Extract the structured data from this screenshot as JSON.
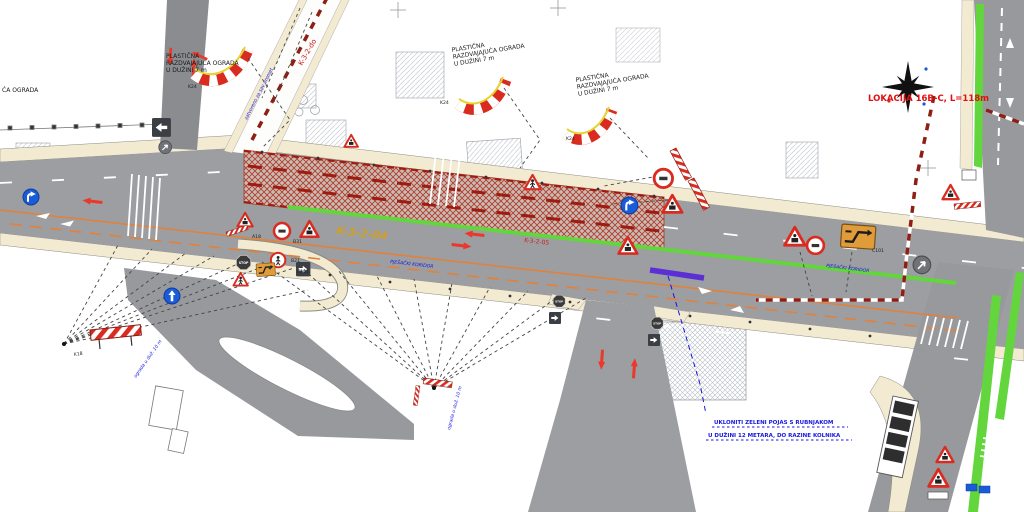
{
  "labels": {
    "fence_line1": "PLASTIČNA",
    "fence_line2": "RAZDVAJAJUĆA OGRADA",
    "fence_line3": "U DUŽINI 7 m",
    "fence_partial": "ĆA OGRADA",
    "k24": "K24",
    "k18": "K18",
    "b21": "B21",
    "b31": "B31",
    "a18": "A18",
    "c101": "C101",
    "stop": "STOP",
    "location": "LOKACIJA 16B-C,  L=118m",
    "road_code_diag": "K-3-2-do",
    "road_code_main": "K-3-2-04",
    "road_code_hatch": "K-3-2-05",
    "note_closed": "zatvoreno za sav promet",
    "ped_corridor": "PJEŠAČKI KORIDOR",
    "note_fence10": "ograda u duž. 10 m",
    "note_remove_line1": "UKLONITI ZELENI POJAS S RUBNJAKOM",
    "note_remove_line2": "U DUŽINI 12 METARA, DO RAZINE KOLNIKA"
  },
  "colors": {
    "construction_hatch_red": "#a83c2c",
    "barrier_red": "#d92b1f",
    "detour_dark_red": "#8e1f14",
    "green_strip": "#62d63c",
    "sidewalk_beige": "#f3ead2",
    "asphalt_gray": "#9c9ea1",
    "orange_line": "#e2813c",
    "annotation_blue": "#1616e0",
    "location_red": "#e01010",
    "road_code_yellow": "#d8a018",
    "purple_marker": "#5b2fd6",
    "sign_blue": "#1a5bd7"
  }
}
